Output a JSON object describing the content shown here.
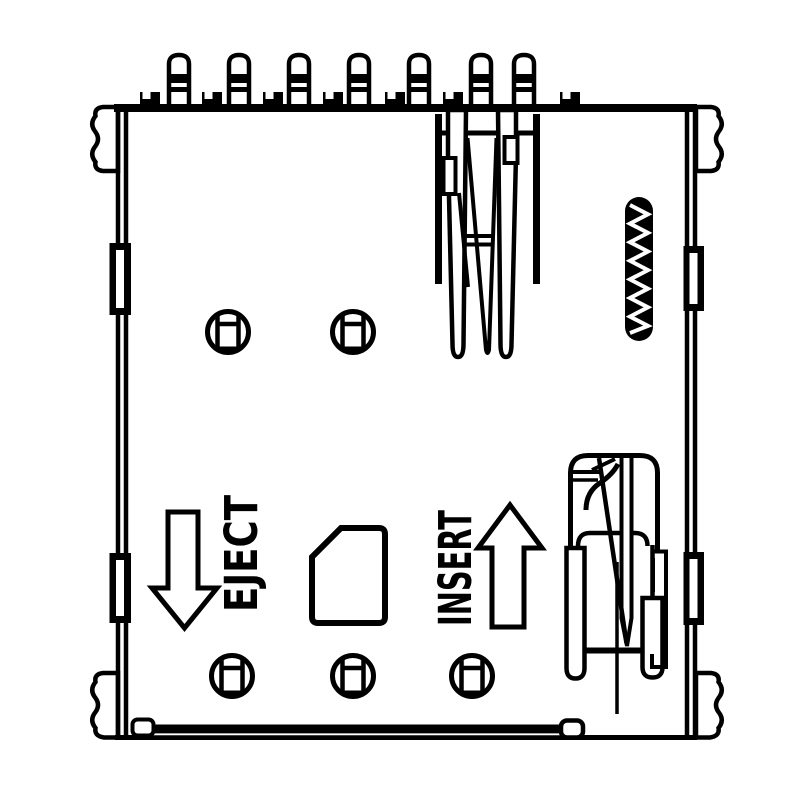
{
  "labels": {
    "eject": "EJECT",
    "insert": "INSERT"
  },
  "icons": {
    "eject_arrow": "down-arrow-outline",
    "insert_arrow": "up-arrow-outline",
    "sim_card": "chamfered-card-outline",
    "coil_spring": "zigzag-spring",
    "screw_post": "circle-with-keyed-slot",
    "mounting_tab": "wavy-solder-tab"
  },
  "colors": {
    "line": "#000000",
    "bg": "#ffffff"
  },
  "counts": {
    "pins": 7,
    "screw_posts": 5,
    "mounting_tabs": 4,
    "edge_notches": 7
  }
}
